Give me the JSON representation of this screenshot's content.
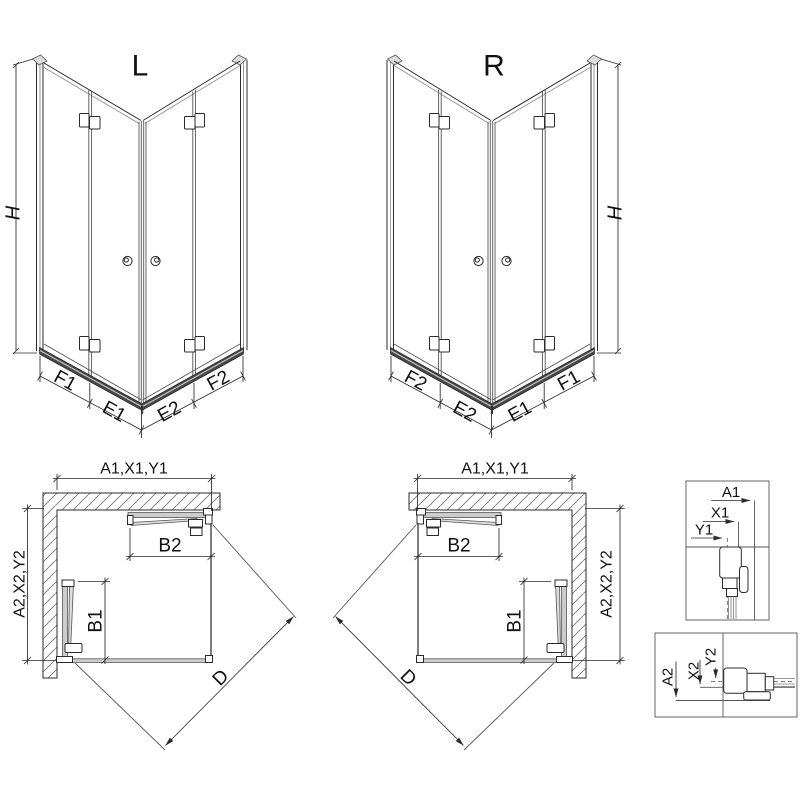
{
  "document": {
    "type": "shower-enclosure-dimension-diagram"
  },
  "figure_left": {
    "label": "L",
    "height_dim": "H",
    "bottom_dims": {
      "outer_left": "F1",
      "inner_left": "E1",
      "inner_right": "E2",
      "outer_right": "F2"
    }
  },
  "figure_right": {
    "label": "R",
    "height_dim": "H",
    "bottom_dims": {
      "outer_left": "F2",
      "inner_left": "E2",
      "inner_right": "E1",
      "outer_right": "F1"
    }
  },
  "plan_left": {
    "width_dim": "A1,X1,Y1",
    "depth_dim": "A2,X2,Y2",
    "door_top_dim": "B2",
    "door_side_dim": "B1",
    "diagonal_dim": "D"
  },
  "plan_right": {
    "width_dim": "A1,X1,Y1",
    "depth_dim": "A2,X2,Y2",
    "door_top_dim": "B2",
    "door_side_dim": "B1",
    "diagonal_dim": "D"
  },
  "detail_width_profile": {
    "dim_a": "A1",
    "dim_x": "X1",
    "dim_y": "Y1"
  },
  "detail_depth_profile": {
    "dim_a": "A2",
    "dim_x": "X2",
    "dim_y": "Y2"
  },
  "colors": {
    "line": "#2b2b2b",
    "frame_gray": "#8f8f8f",
    "rail_dark": "#474747",
    "panel_fill": "#cccccc",
    "hatch": "#777777",
    "background": "#ffffff"
  }
}
